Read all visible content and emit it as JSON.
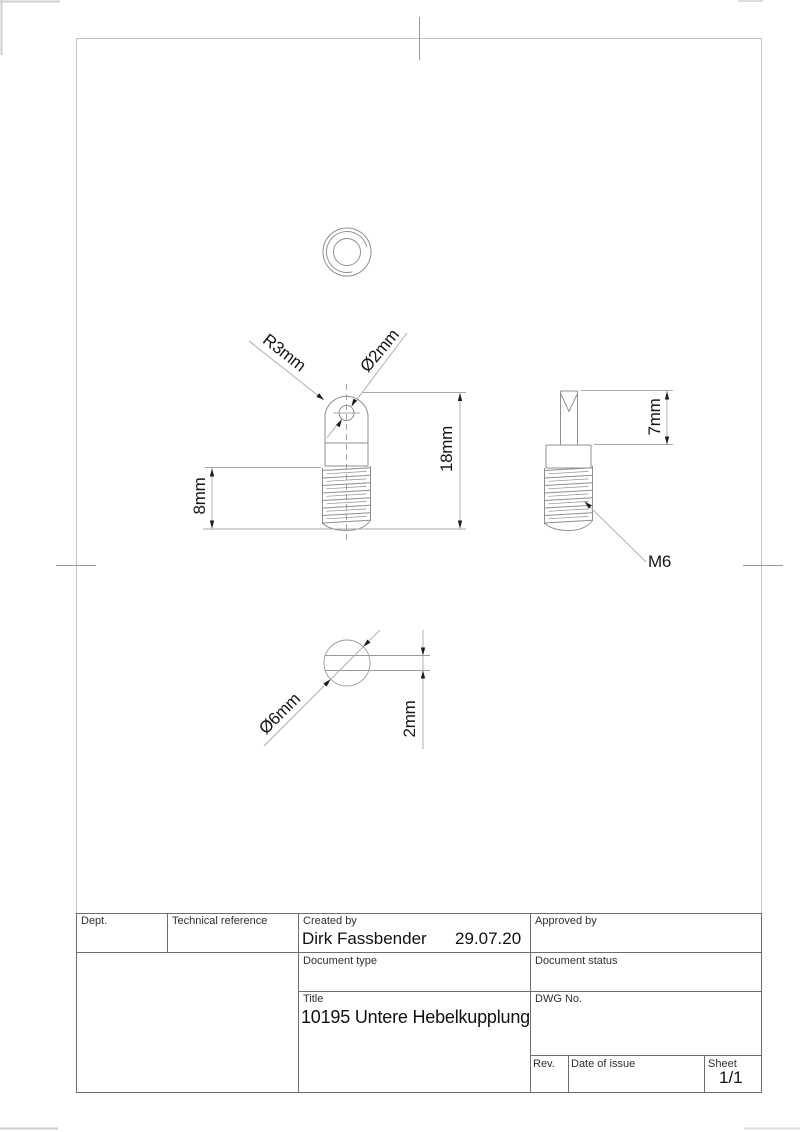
{
  "colors": {
    "part_line": "#8f8f8f",
    "dimension_line": "#a9a9a9",
    "arrow_and_text": "#1c1c1c",
    "frame_line": "#c4c4c4",
    "title_block_line": "#6e6e6e",
    "background": "#ffffff"
  },
  "drawing": {
    "dimensions": {
      "radius_top": "R3mm",
      "hole_diameter": "Ø2mm",
      "total_height": "18mm",
      "thread_length": "8mm",
      "tab_height": "7mm",
      "thread_spec": "M6",
      "tab_diameter": "Ø6mm",
      "tab_thickness": "2mm"
    }
  },
  "title_block": {
    "dept_label": "Dept.",
    "technical_reference_label": "Technical reference",
    "created_by_label": "Created by",
    "created_by_value": "Dirk Fassbender",
    "created_date": "29.07.20",
    "approved_by_label": "Approved by",
    "document_type_label": "Document type",
    "document_status_label": "Document status",
    "title_label": "Title",
    "title_value": "10195 Untere Hebelkupplung",
    "dwg_no_label": "DWG No.",
    "rev_label": "Rev.",
    "date_of_issue_label": "Date of issue",
    "sheet_label": "Sheet",
    "sheet_value": "1/1"
  }
}
